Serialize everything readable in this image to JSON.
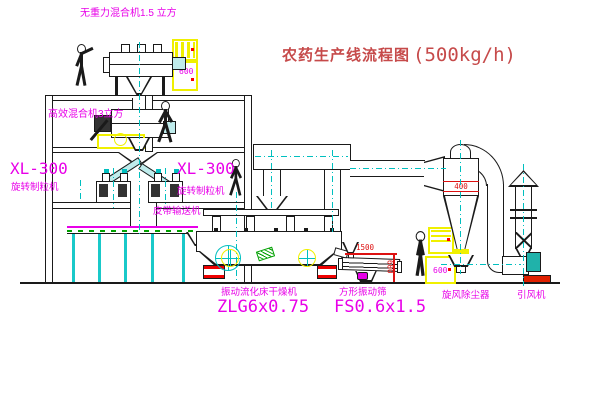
{
  "title": {
    "text": "农药生产线流程图",
    "capacity": "(500kg/h)"
  },
  "labels": {
    "premix_mixer": "无重力混合机1.5 立方",
    "high_efficiency_mixer": "高效混合机3立方",
    "granulator_left_model": "XL-300",
    "granulator_left_name": "旋转制粒机",
    "granulator_mid_model": "XL-300",
    "granulator_mid_name": "旋转制粒机",
    "belt_conveyor": "皮带输送机",
    "fluid_bed_dryer": "振动流化床干燥机",
    "fluid_bed_dryer_model": "ZLG6x0.75",
    "vibrating_sieve": "方形振动筛",
    "vibrating_sieve_model": "FS0.6x1.5",
    "cyclone": "旋风除尘器",
    "induced_draft_fan": "引风机"
  },
  "dims": {
    "cyclone_dia": "400",
    "sieve_length": "1500",
    "sieve_width": "600",
    "elevator_mark": "600",
    "cabinet_mark": "600"
  },
  "colors": {
    "label_magenta": "#e800e8",
    "title_red": "#c64a4a",
    "line_black": "#1a1a1a",
    "centerline_cyan": "#00bfbf",
    "highlight_yellow": "#f0f000",
    "dimension_red": "#dd1111",
    "belt_green": "#00a000",
    "fan_motor_teal": "#20b2aa"
  }
}
